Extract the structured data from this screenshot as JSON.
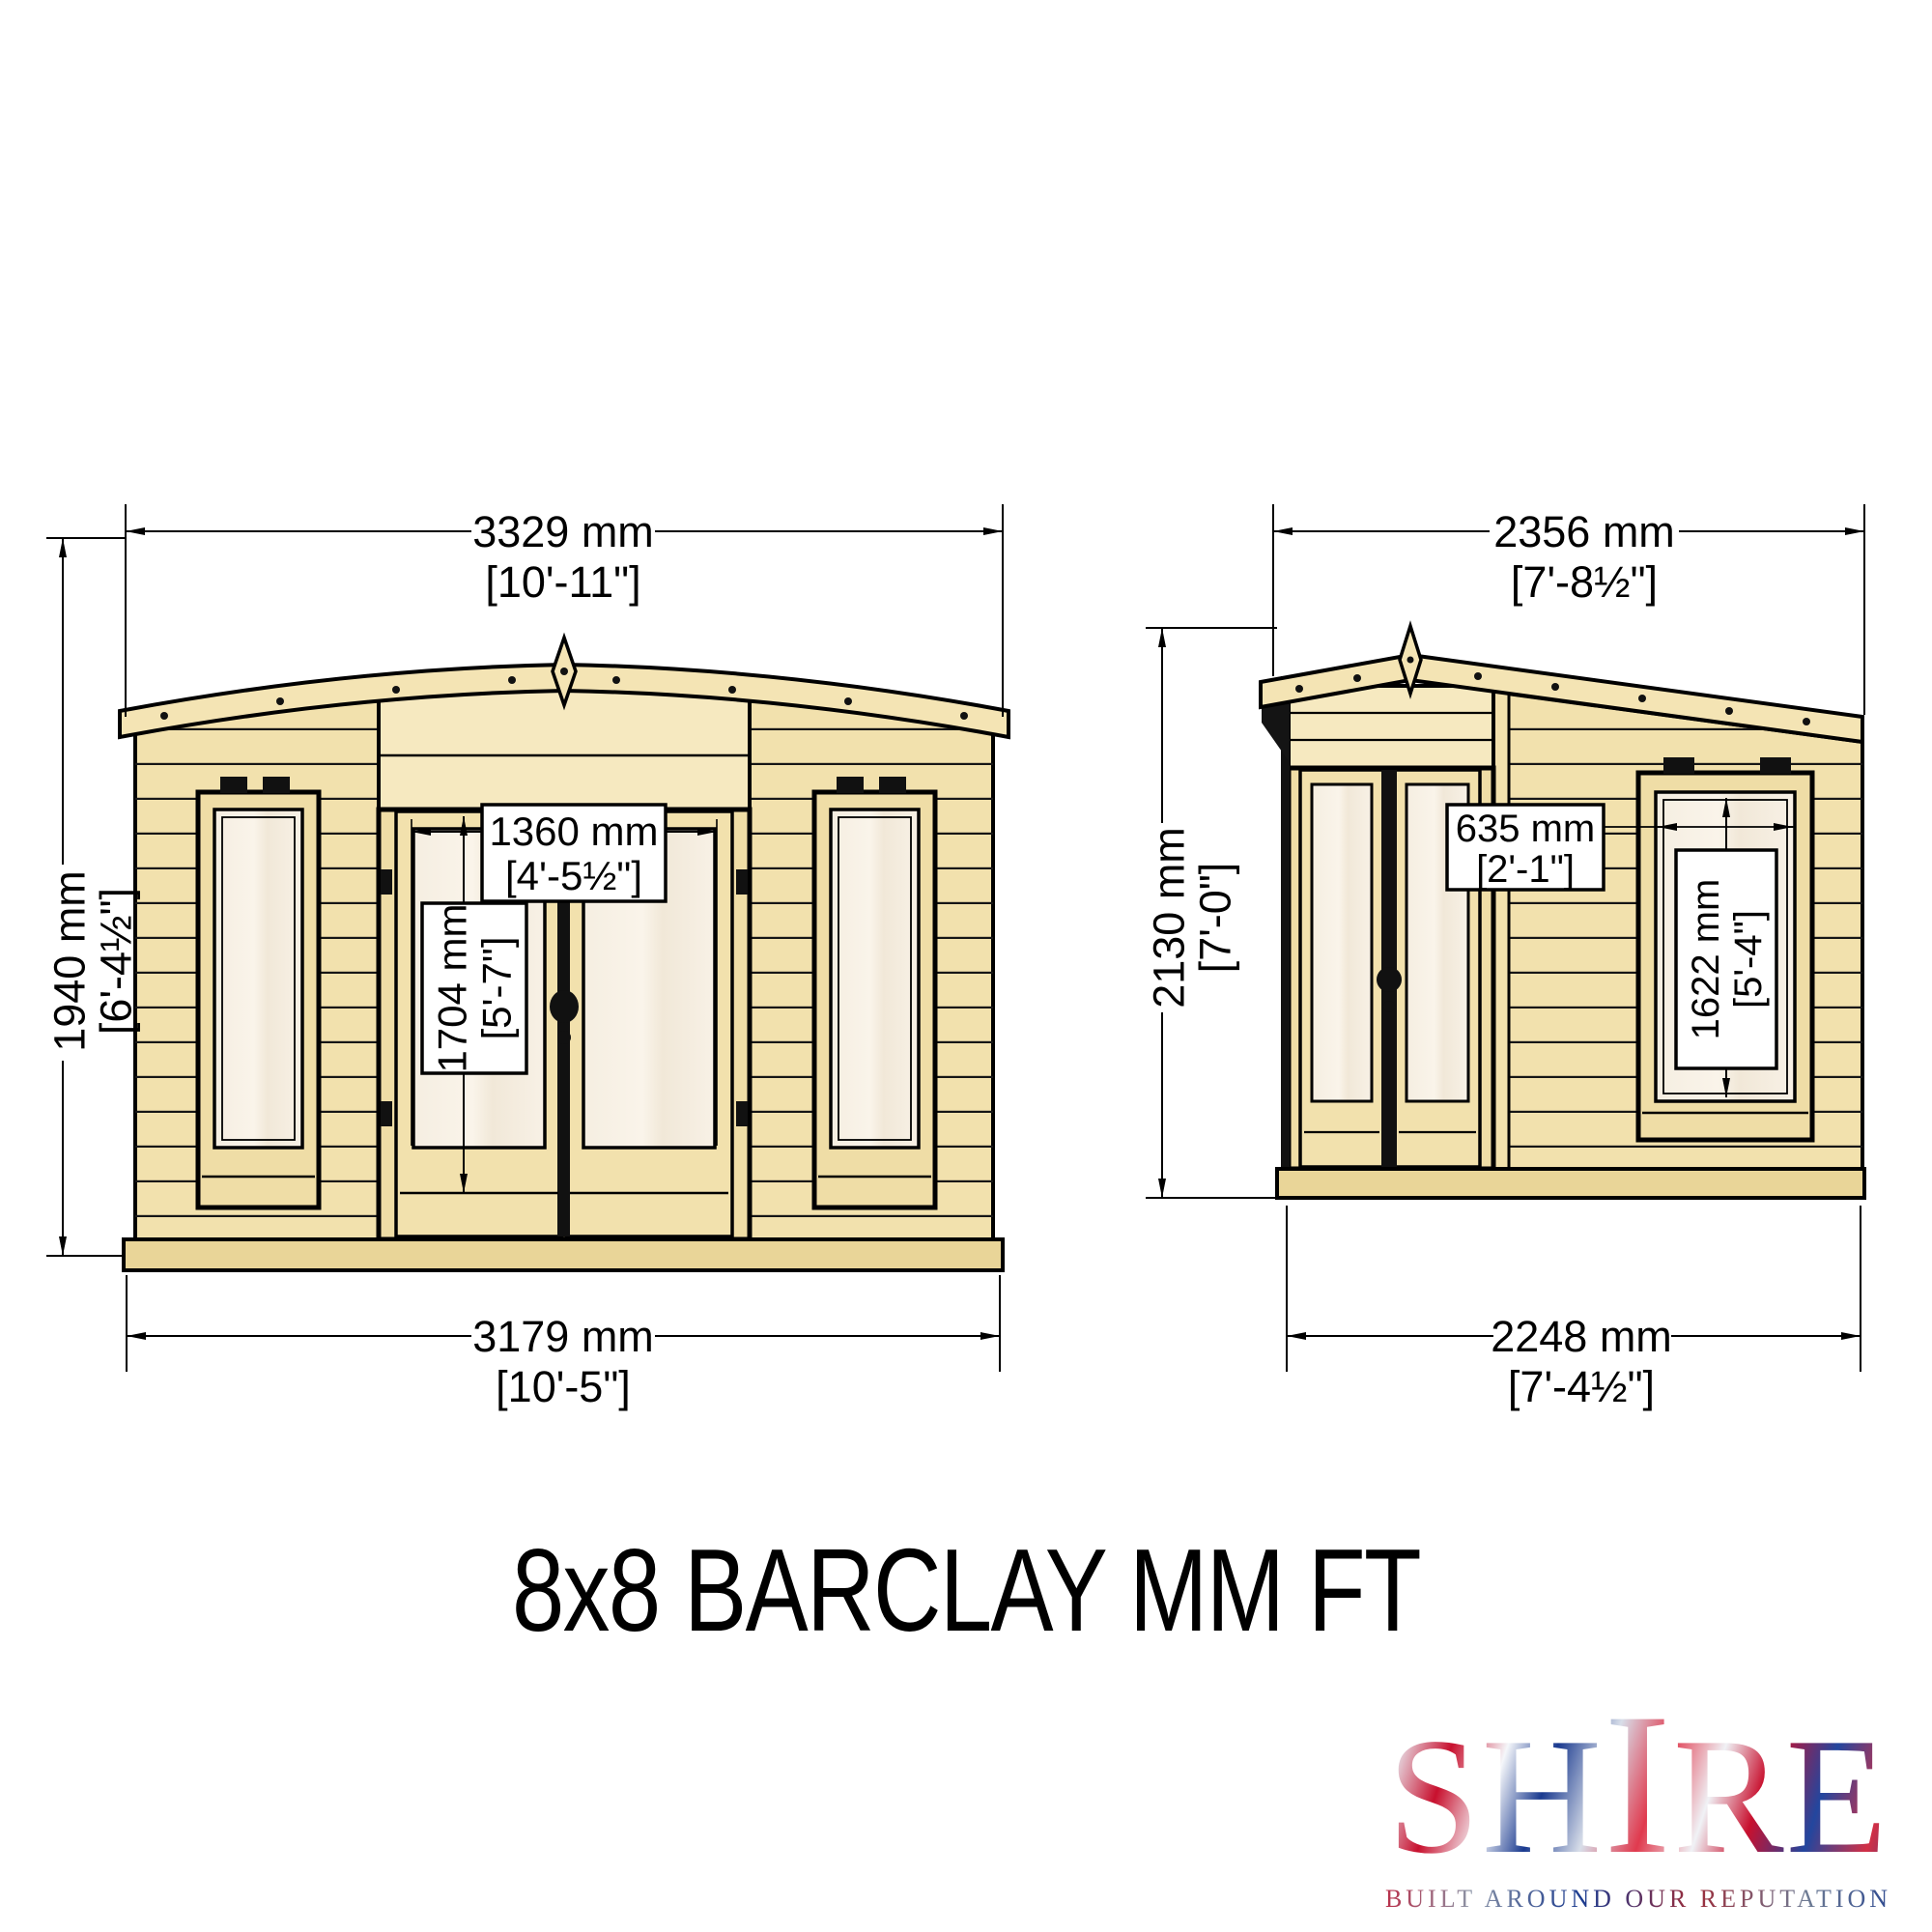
{
  "title": "8x8 BARCLAY MM FT",
  "logo": {
    "part1": "SH",
    "part_tall": "I",
    "part2": "RE",
    "tagline": "BUILT AROUND OUR REPUTATION"
  },
  "front": {
    "overall_width_mm": "3329 mm",
    "overall_width_ft": "[10'-11\"]",
    "height_mm": "1940 mm",
    "height_ft": "[6'-4½\"]",
    "door_width_mm": "1360 mm",
    "door_width_ft": "[4'-5½\"]",
    "door_height_mm": "1704 mm",
    "door_height_ft": "[5'-7\"]",
    "base_width_mm": "3179 mm",
    "base_width_ft": "[10'-5\"]"
  },
  "side": {
    "overall_width_mm": "2356 mm",
    "overall_width_ft": "[7'-8½\"]",
    "height_mm": "2130 mm",
    "height_ft": "[7'-0\"]",
    "window_width_mm": "635 mm",
    "window_width_ft": "[2'-1\"]",
    "window_height_mm": "1622 mm",
    "window_height_ft": "[5'-4\"]",
    "base_width_mm": "2248 mm",
    "base_width_ft": "[7'-4½\"]"
  },
  "colors": {
    "wood": "#f2e1ad",
    "wood_light": "#f6e9c0",
    "wood_dark": "#e9d598",
    "glass": "#f7f0e4",
    "outline": "#000000",
    "logo_red": "#c8102e",
    "logo_blue": "#1a3a8f"
  }
}
